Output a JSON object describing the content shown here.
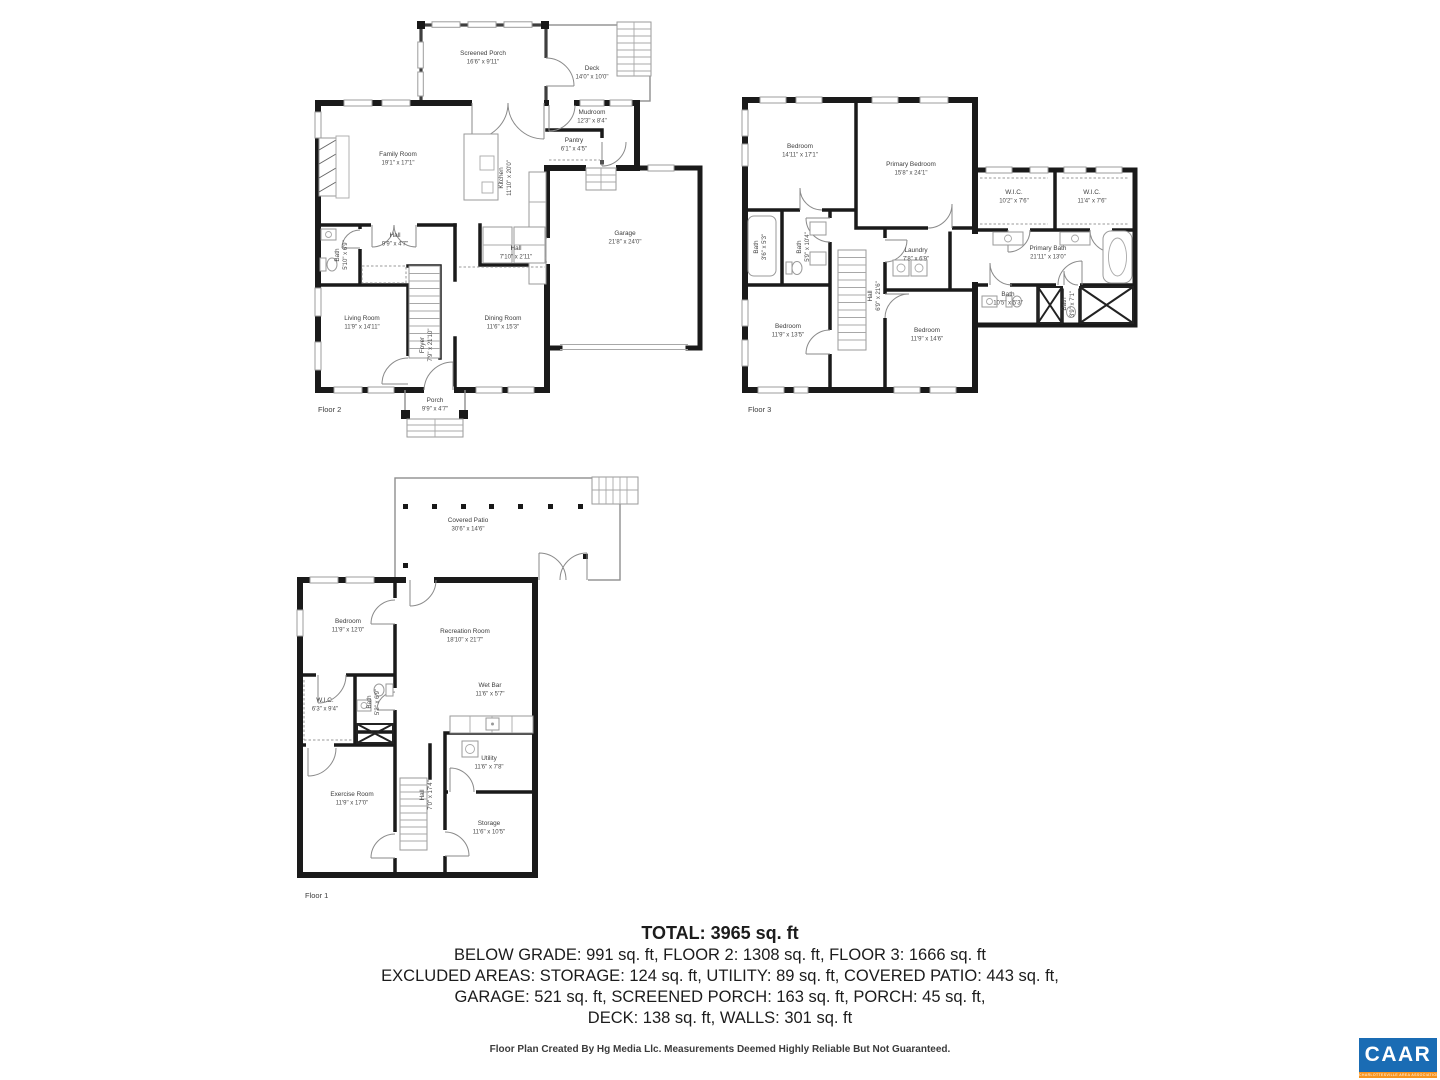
{
  "floors": {
    "floor2": {
      "label": "Floor 2",
      "rooms": {
        "screened_porch": {
          "name": "Screened Porch",
          "dims": "16'6\" x 9'11\""
        },
        "deck": {
          "name": "Deck",
          "dims": "14'0\" x 10'0\""
        },
        "family_room": {
          "name": "Family Room",
          "dims": "19'1\" x 17'1\""
        },
        "kitchen": {
          "name": "Kitchen",
          "dims": "11'10\" x 20'0\""
        },
        "mudroom": {
          "name": "Mudroom",
          "dims": "12'3\" x 8'4\""
        },
        "pantry": {
          "name": "Pantry",
          "dims": "6'1\" x 4'5\""
        },
        "garage": {
          "name": "Garage",
          "dims": "21'8\" x 24'0\""
        },
        "hall": {
          "name": "Hall",
          "dims": "9'9\" x 4'7\""
        },
        "bath": {
          "name": "Bath",
          "dims": "5'10\" x 6'9\""
        },
        "living_room": {
          "name": "Living Room",
          "dims": "11'9\" x 14'11\""
        },
        "foyer": {
          "name": "Foyer",
          "dims": "7'9\" x 21'10\""
        },
        "dining_room": {
          "name": "Dining Room",
          "dims": "11'6\" x 15'3\""
        },
        "hall2": {
          "name": "Hall",
          "dims": "7'10\" x 2'11\""
        },
        "porch": {
          "name": "Porch",
          "dims": "9'9\" x 4'7\""
        }
      }
    },
    "floor3": {
      "label": "Floor 3",
      "rooms": {
        "bedroom1": {
          "name": "Bedroom",
          "dims": "14'11\" x 17'1\""
        },
        "primary_bedroom": {
          "name": "Primary Bedroom",
          "dims": "15'8\" x 24'1\""
        },
        "wic1": {
          "name": "W.I.C.",
          "dims": "10'2\" x 7'6\""
        },
        "wic2": {
          "name": "W.I.C.",
          "dims": "11'4\" x 7'6\""
        },
        "primary_bath": {
          "name": "Primary Bath",
          "dims": "21'11\" x 13'0\""
        },
        "bath_small": {
          "name": "Bath",
          "dims": "3'6\" x 5'3\""
        },
        "bath_mid": {
          "name": "Bath",
          "dims": "5'9\" x 10'4\""
        },
        "laundry": {
          "name": "Laundry",
          "dims": "7'8\" x 6'9\""
        },
        "hall": {
          "name": "Hall",
          "dims": "6'9\" x 21'6\""
        },
        "bedroom2": {
          "name": "Bedroom",
          "dims": "11'9\" x 13'5\""
        },
        "bedroom3": {
          "name": "Bedroom",
          "dims": "11'9\" x 14'6\""
        },
        "bath3": {
          "name": "Bath",
          "dims": "10'5\" x 5'3\""
        },
        "bath4": {
          "name": "Bath",
          "dims": "3'9\" x 7'1\""
        }
      }
    },
    "floor1": {
      "label": "Floor 1",
      "rooms": {
        "covered_patio": {
          "name": "Covered Patio",
          "dims": "30'6\" x 14'6\""
        },
        "bedroom": {
          "name": "Bedroom",
          "dims": "11'9\" x 12'0\""
        },
        "recreation_room": {
          "name": "Recreation Room",
          "dims": "18'10\" x 21'7\""
        },
        "wic": {
          "name": "W.I.C.",
          "dims": "6'3\" x 9'4\""
        },
        "bath": {
          "name": "Bath",
          "dims": "5'2\" x 6'9\""
        },
        "wet_bar": {
          "name": "Wet Bar",
          "dims": "11'6\" x 5'7\""
        },
        "utility": {
          "name": "Utility",
          "dims": "11'6\" x 7'8\""
        },
        "exercise_room": {
          "name": "Exercise Room",
          "dims": "11'9\" x 17'0\""
        },
        "hall": {
          "name": "Hall",
          "dims": "7'0\" x 17'4\""
        },
        "storage": {
          "name": "Storage",
          "dims": "11'6\" x 10'5\""
        }
      }
    }
  },
  "summary": {
    "total": "TOTAL: 3965 sq. ft",
    "line1": "BELOW GRADE: 991 sq. ft, FLOOR 2: 1308 sq. ft, FLOOR 3: 1666 sq. ft",
    "line2": "EXCLUDED AREAS: STORAGE: 124 sq. ft, UTILITY: 89 sq. ft, COVERED PATIO: 443 sq. ft,",
    "line3": "GARAGE: 521 sq. ft, SCREENED PORCH: 163 sq. ft, PORCH: 45 sq. ft,",
    "line4": "DECK: 138 sq. ft, WALLS: 301 sq. ft"
  },
  "credit": "Floor Plan Created By Hg Media Llc. Measurements Deemed Highly Reliable But Not Guaranteed.",
  "logo": {
    "word": "CAAR",
    "strip": "CHARLOTTESVILLE AREA ASSOCIATION OF REALTORS",
    "blue": "#1a6cb4",
    "orange": "#f7941e"
  }
}
